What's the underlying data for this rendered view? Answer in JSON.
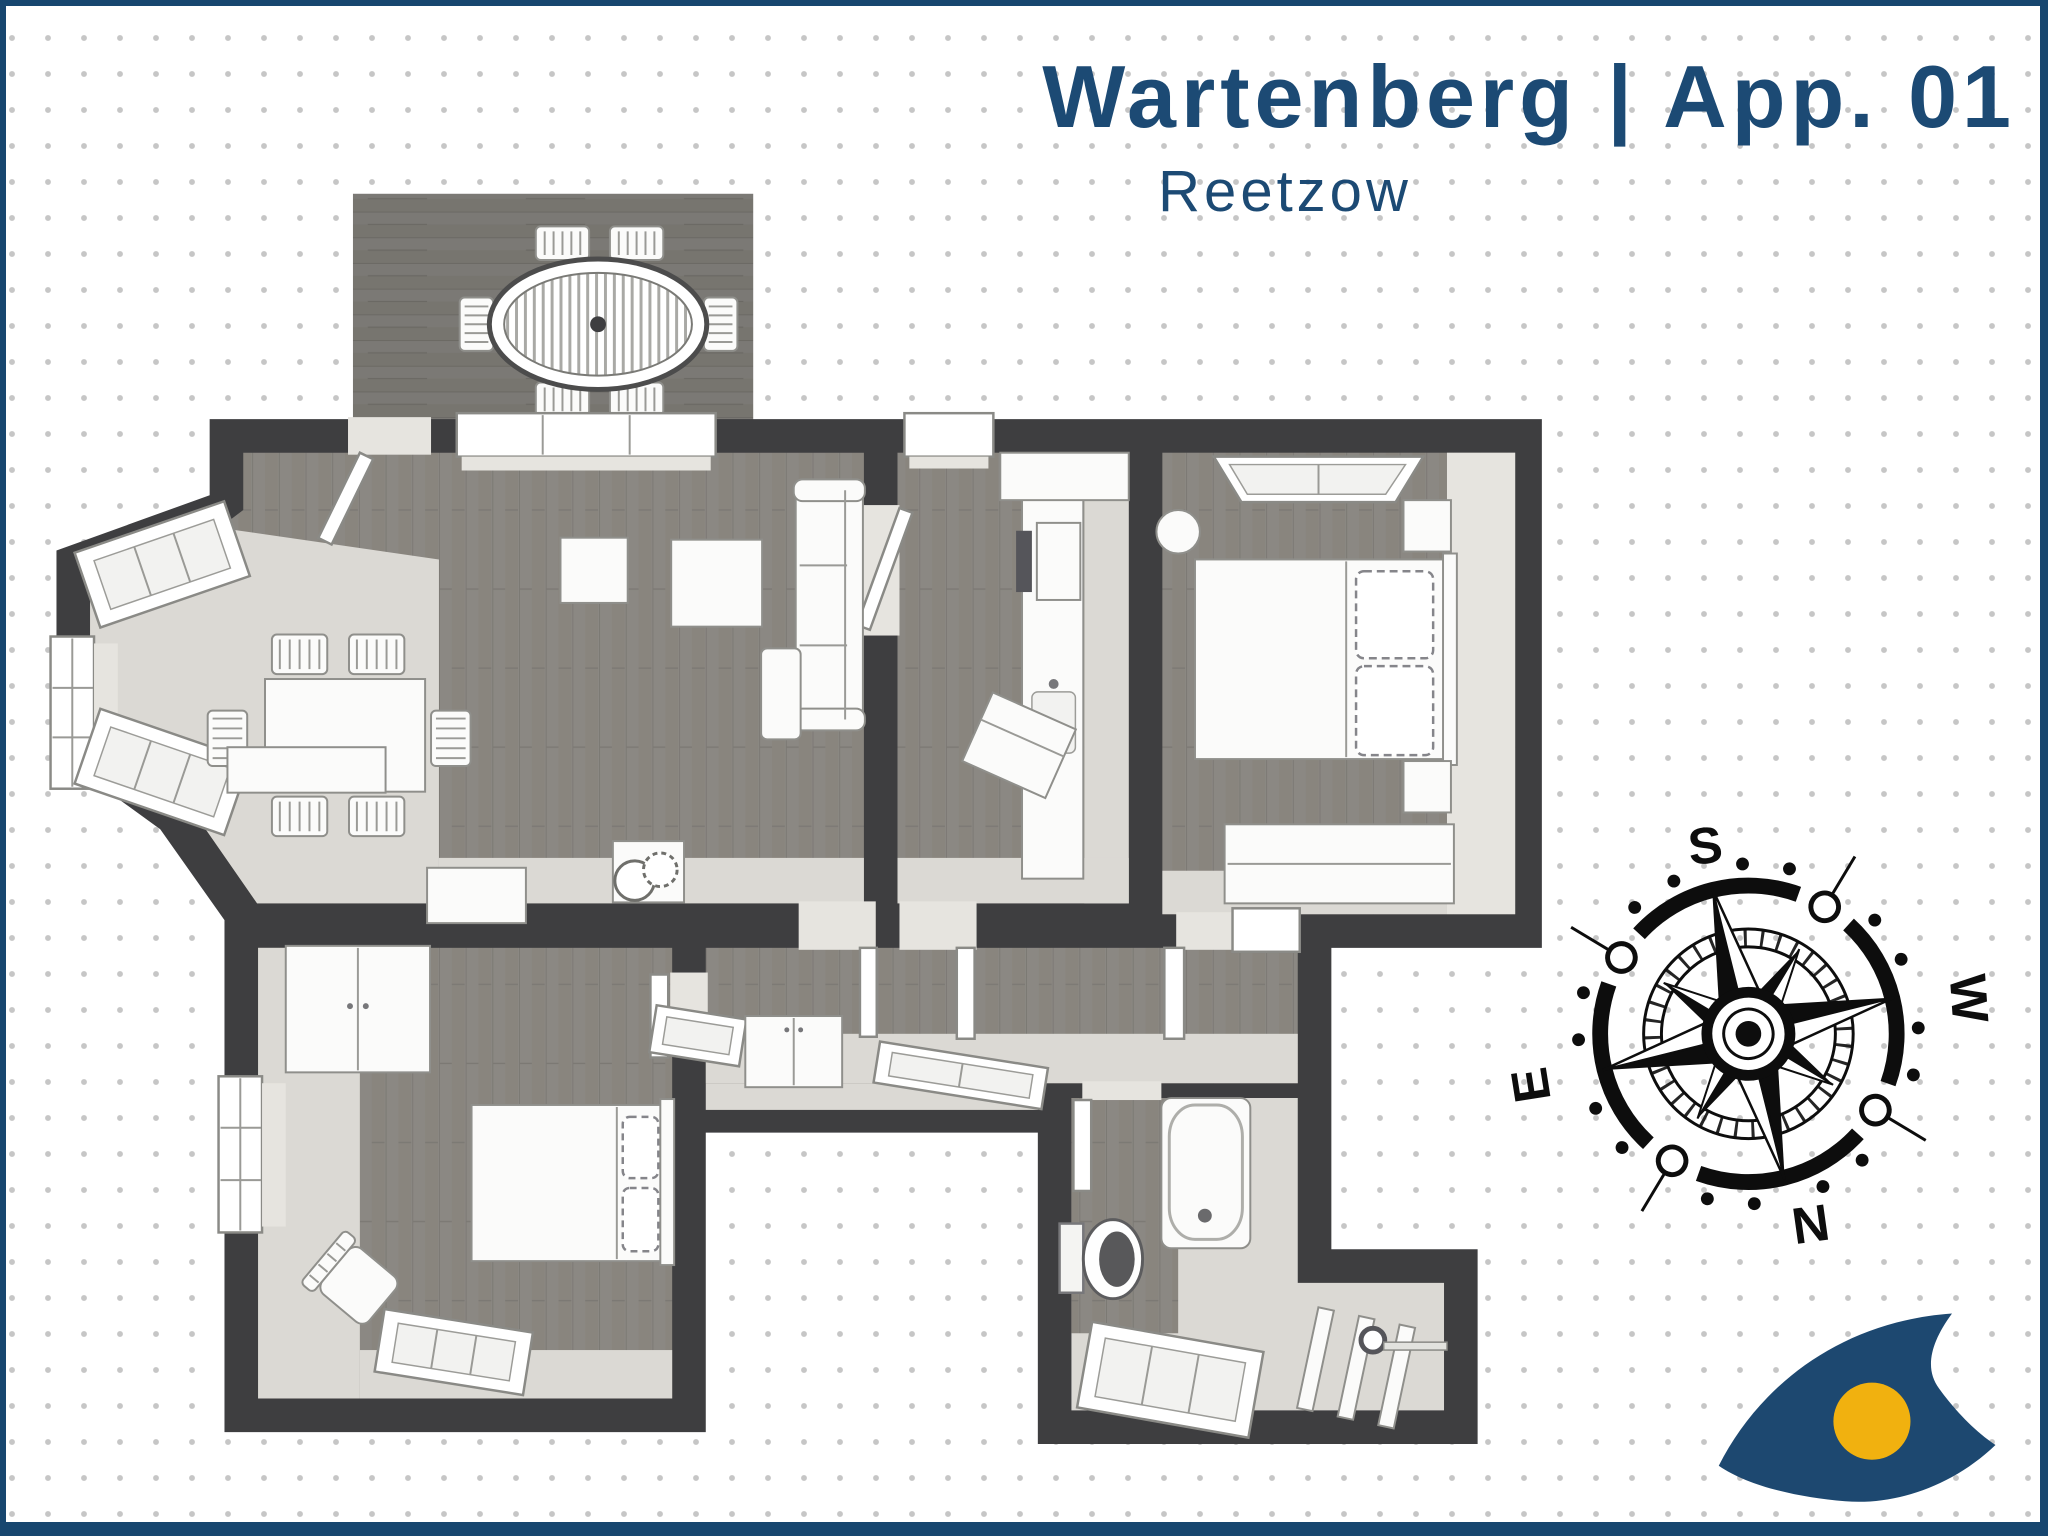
{
  "header": {
    "title": "Wartenberg | App. 01",
    "subtitle": "Reetzow"
  },
  "compass": {
    "labels": {
      "top": "S",
      "right": "W",
      "left": "E",
      "bottom": "N"
    }
  },
  "theme": {
    "accent_blue": "#1c4a74",
    "border_blue": "#17466f",
    "wall_gray": "#3e3e40",
    "wood_floor": "#8b8883",
    "terrace_wood": "#7b7975",
    "light_floor": "#dbd9d4",
    "furniture_white": "#fbfbfa",
    "logo_blue": "#1d4870",
    "logo_yellow": "#f1b10f",
    "dot_gray": "#c6c6c6"
  }
}
